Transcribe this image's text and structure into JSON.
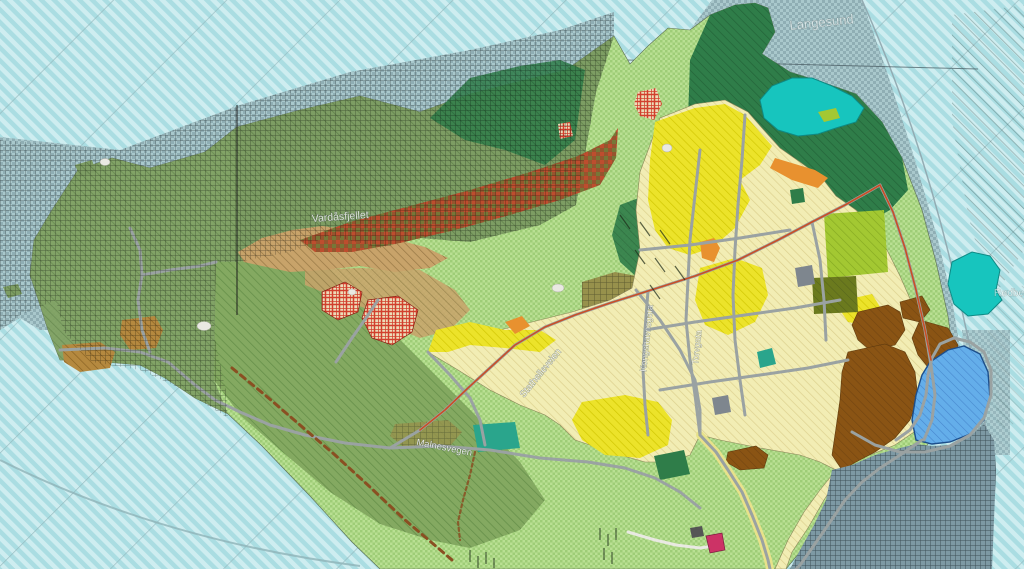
{
  "labels": {
    "sea": "Langesund",
    "ridge": "Vardåsfjellet",
    "road_center": "Malnesvegen",
    "road_diag": "Stathelleveien",
    "road_v1": "Kongshavnsgata",
    "road_v2": "Torvgata",
    "edge": "Rødberget"
  },
  "palette": {
    "water": "#aadde2",
    "water_stripe": "#d9f3f4",
    "water_line": "#8fb3b8",
    "sea_zone": "#a9c8cc",
    "sea_zone_dot": "#6e8f96",
    "sea_dark": "#7d99a4",
    "sea_dark_grid": "#1c2b31",
    "land_light": "#b9e093",
    "land_hatch": "#8fc468",
    "land_medium": "#84a961",
    "band_green": "#7d9d63",
    "forest_green": "#2f7d49",
    "forest_dark": "#5c7544",
    "lake_teal": "#17c5be",
    "ridge_brown": "#96552e",
    "ridge_red": "#c84b2e",
    "ridge_olive": "#6f7f3a",
    "tan": "#c8a36a",
    "tan_hatch": "#8a6a3a",
    "yellow_bright": "#ece32a",
    "yellow_pale": "#f2edb4",
    "yellow_pale_hatch": "#d8cd8a",
    "orange": "#e8912f",
    "red": "#cf2d1d",
    "brown_zone": "#8a5414",
    "harbor_blue": "#64aeea",
    "harbor_hatch": "#3a78c0",
    "teal_parcel": "#2aa58c",
    "lime": "#a3c832",
    "olive_dark": "#6b7a1e",
    "khaki": "#97914c",
    "gray_parcel": "#7e868e",
    "road": "#9aa2a2",
    "road_red": "#cc4b20",
    "path_white": "#e9e9e2",
    "dash_brown": "#8a4f22",
    "pink": "#cc3366",
    "field_brown": "#b5893f",
    "label_white": "#ffffff"
  }
}
